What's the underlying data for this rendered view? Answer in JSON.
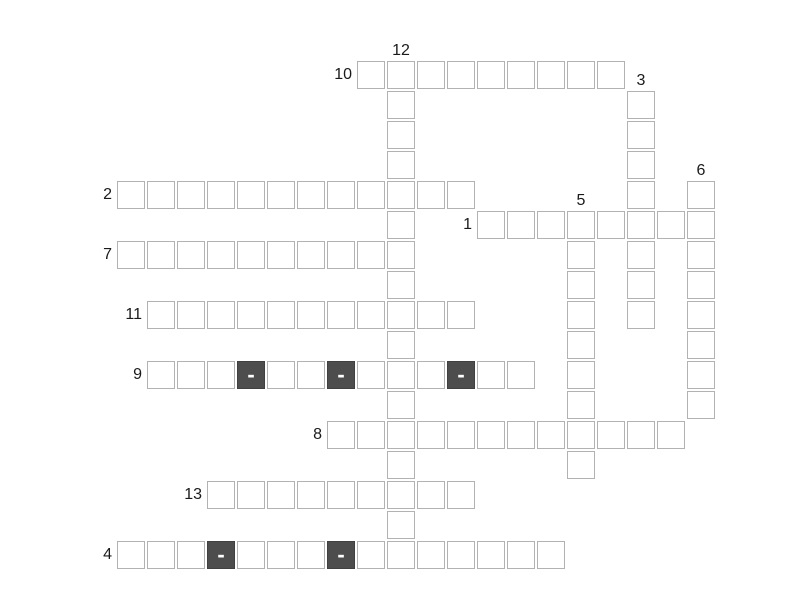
{
  "puzzle": {
    "background": "#ffffff",
    "colors": {
      "cell_fill": "#ffffff",
      "cell_border": "#b2b2b2",
      "hyphen_cell_fill": "#4d4d4d",
      "hyphen_cell_border": "#404040",
      "hyphen_text": "#ffffff",
      "number_text": "#1a1a1a"
    },
    "symbols": {
      "hyphen": "-"
    },
    "grid": {
      "origin_x": 117,
      "origin_y": 61,
      "pitch": 30,
      "cell_size": 28,
      "rows": 17,
      "cols": 20
    },
    "entries": [
      {
        "number": 10,
        "direction": "across",
        "row": 0,
        "col": 8,
        "length": 9
      },
      {
        "number": 12,
        "direction": "down",
        "row": 0,
        "col": 9,
        "length": 17
      },
      {
        "number": 3,
        "direction": "down",
        "row": 1,
        "col": 17,
        "length": 8
      },
      {
        "number": 2,
        "direction": "across",
        "row": 4,
        "col": 0,
        "length": 12
      },
      {
        "number": 6,
        "direction": "down",
        "row": 4,
        "col": 19,
        "length": 8
      },
      {
        "number": 1,
        "direction": "across",
        "row": 5,
        "col": 12,
        "length": 8
      },
      {
        "number": 5,
        "direction": "down",
        "row": 5,
        "col": 15,
        "length": 9
      },
      {
        "number": 7,
        "direction": "across",
        "row": 6,
        "col": 0,
        "length": 10
      },
      {
        "number": 11,
        "direction": "across",
        "row": 8,
        "col": 1,
        "length": 11
      },
      {
        "number": 9,
        "direction": "across",
        "row": 10,
        "col": 1,
        "length": 13,
        "hyphens": [
          3,
          6,
          10
        ]
      },
      {
        "number": 8,
        "direction": "across",
        "row": 12,
        "col": 7,
        "length": 12
      },
      {
        "number": 13,
        "direction": "across",
        "row": 14,
        "col": 3,
        "length": 9
      },
      {
        "number": 4,
        "direction": "across",
        "row": 16,
        "col": 0,
        "length": 15,
        "hyphens": [
          3,
          7
        ]
      }
    ]
  }
}
